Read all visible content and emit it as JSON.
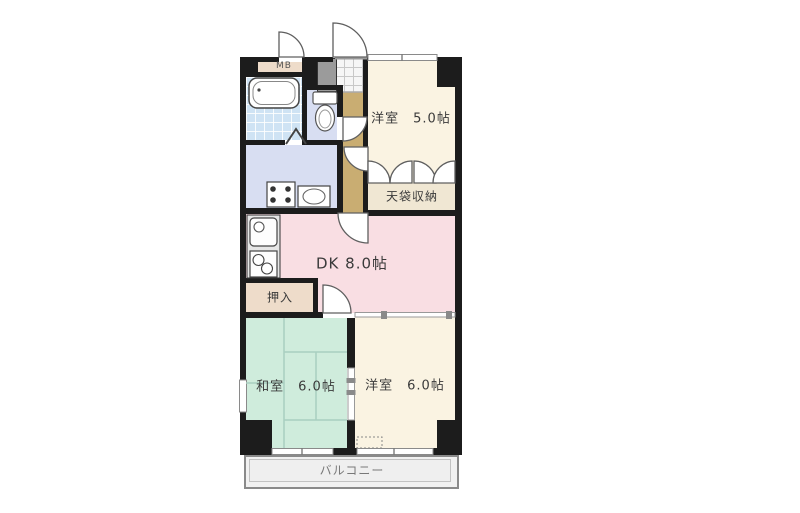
{
  "rooms": {
    "mb": "MB",
    "bedroom5": "洋室　5.0帖",
    "storage_top": "天袋収納",
    "dk": "DK 8.0帖",
    "oshiire": "押入",
    "washitsu": "和室　6.0帖",
    "bedroom6": "洋室　6.0帖",
    "balcony": "バルコニー"
  },
  "colors": {
    "wall": "#1c1c1c",
    "dk_pink": "#f9dee3",
    "washitsu_green": "#cfecdc",
    "bedroom_cream": "#faf3e2",
    "wet_area_lavender": "#d8def2",
    "bath_tile_blue": "#cfe3f4",
    "hallway_tan": "#c9ad72",
    "closet_tan": "#eedcca",
    "balcony_gray": "#f1f1f1"
  }
}
